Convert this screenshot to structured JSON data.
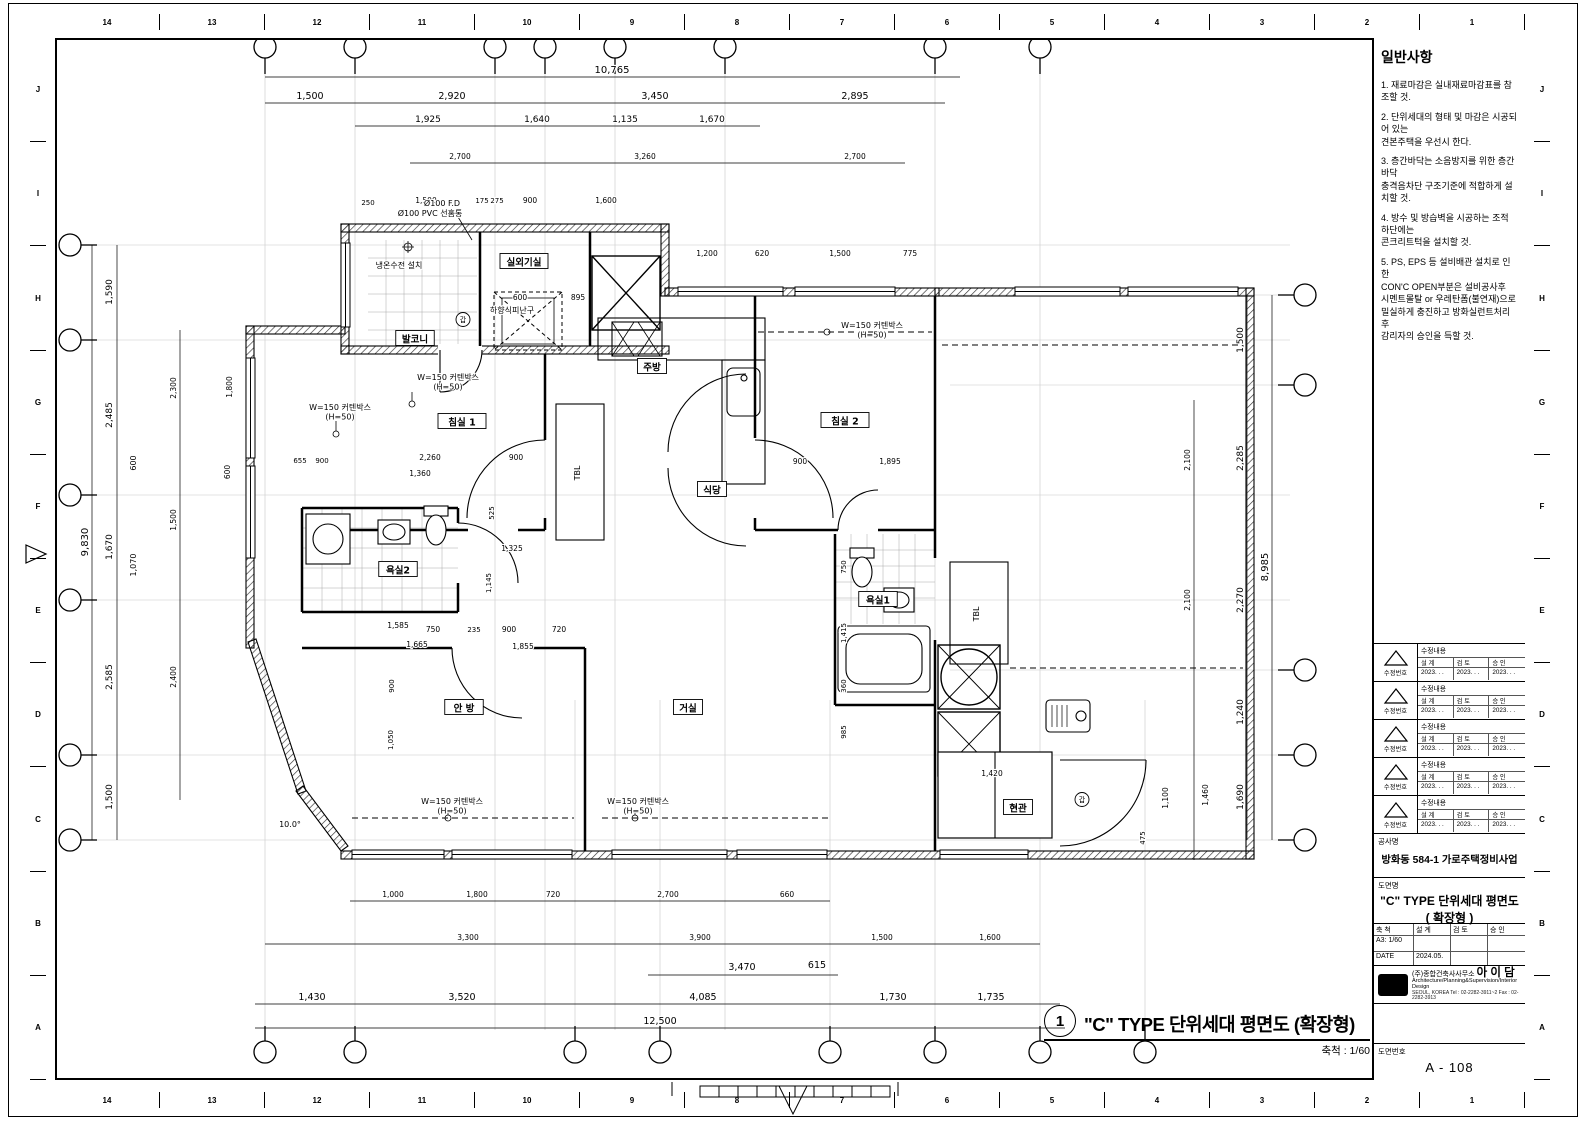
{
  "sheet": {
    "top_ruler": [
      "14",
      "13",
      "12",
      "11",
      "10",
      "9",
      "8",
      "7",
      "6",
      "5",
      "4",
      "3",
      "2",
      "1"
    ],
    "bottom_ruler": [
      "14",
      "13",
      "12",
      "11",
      "10",
      "9",
      "8",
      "7",
      "6",
      "5",
      "4",
      "3",
      "2",
      "1"
    ],
    "left_ruler": [
      "J",
      "I",
      "H",
      "G",
      "F",
      "E",
      "D",
      "C",
      "B",
      "A"
    ],
    "right_ruler": [
      "J",
      "I",
      "H",
      "G",
      "F",
      "E",
      "D",
      "C",
      "B",
      "A"
    ]
  },
  "notes": {
    "title": "일반사항",
    "items": [
      "1. 재료마감은 실내재료마감표를 참조할 것.",
      "2. 단위세대의 형태 및 마감은 시공되어 있는\n    견본주택을 우선시 한다.",
      "3. 층간바닥는 소음방지를 위한 층간바닥\n 충격음차단 구조기준에 적합하게 설치할 것.",
      "4. 방수 및 방습벽을 시공하는 조적 하단에는\n    콘크리트턱을 설치할 것.",
      "5. PS, EPS 등 설비배관 설치로 인한\n    CON'C OPEN부분은 설비공사후\n    시멘트몰탈 or 우레탄폼(불연재)으로\n    밀실하게 충진하고 방화실런트처리후\n    감리자의 승인을 득할 것."
    ]
  },
  "revision": {
    "content_label": "수정내용",
    "number_label": "수정번호",
    "design_label": "설 계",
    "review_label": "검 토",
    "approve_label": "승 인",
    "date": "2023.    .    ."
  },
  "titleblock": {
    "project_label": "공사명",
    "project_name": "방화동 584-1 가로주택정비사업",
    "drawing_label": "도면명",
    "drawing_name_line1": "\"C\" TYPE 단위세대 평면도",
    "drawing_name_line2": "( 확장형 )",
    "scale_label": "축 척",
    "scale_value": "A3: 1/60",
    "design_label": "설 계",
    "review_label": "검 토",
    "approve_label": "승 인",
    "date_label": "DATE",
    "date_value": "2024.05.",
    "company_prefix": "(주)종합건축사사무소",
    "company_name": "아 이 담",
    "company_sub": "Architecture/Planning&Supervision/Interior Design",
    "company_addr": "SEOUL, KOREA   Tel : 02-2282-3911~2   Fax : 02-2282-3913",
    "dwgno_label": "도면번호",
    "dwgno_value": "A - 108"
  },
  "plan_title": {
    "bubble": "1",
    "text": "\"C\" TYPE 단위세대 평면도 (확장형)",
    "scale_text": "축척 :   1/60"
  },
  "plan": {
    "rooms": [
      "발코니",
      "실외기실",
      "침실 1",
      "침실 2",
      "주방",
      "식당",
      "욕실2",
      "욕실1",
      "안 방",
      "거실",
      "현관"
    ],
    "annotations": [
      "Ø100 F.D",
      "Ø100 PVC 선홈통",
      "냉온수전 설치",
      "하향식피난구",
      "W=150 커텐박스\n(H=50)",
      "W=150 커텐박스\n(H=50)",
      "W=150 커텐박스\n(H=50)",
      "W=150 커텐박스\n(H=50)",
      "W=150 커텐박스\n(H=50)",
      "TBL",
      "TBL",
      "갑",
      "갑"
    ],
    "dims": [
      "10,765",
      "1,500",
      "2,920",
      "3,450",
      "2,895",
      "1,925",
      "1,640",
      "1,135",
      "1,670",
      "2,700",
      "3,260",
      "2,700",
      "250",
      "1,500",
      "175",
      "275",
      "900",
      "1,600",
      "1,200",
      "620",
      "1,500",
      "775",
      "9,830",
      "1,590",
      "2,485",
      "600",
      "1,670",
      "1,070",
      "2,585",
      "1,500",
      "2,300",
      "1,500",
      "2,400",
      "1,800",
      "600",
      "8,985",
      "1,500",
      "2,285",
      "2,270",
      "1,240",
      "1,690",
      "2,100",
      "2,100",
      "1,460",
      "1,100",
      "475",
      "1,000",
      "1,800",
      "720",
      "2,700",
      "660",
      "3,300",
      "3,900",
      "1,500",
      "1,600",
      "3,470",
      "615",
      "1,430",
      "3,520",
      "4,085",
      "1,730",
      "1,735",
      "12,500",
      "2,260",
      "1,360",
      "900",
      "525",
      "1,325",
      "1,145",
      "750",
      "235",
      "900",
      "720",
      "1,665",
      "1,855",
      "900",
      "1,050",
      "900",
      "1,895",
      "600",
      "895",
      "1,420",
      "750",
      "1,415",
      "360",
      "985",
      "1,585",
      "10.0°",
      "655",
      "900"
    ]
  }
}
